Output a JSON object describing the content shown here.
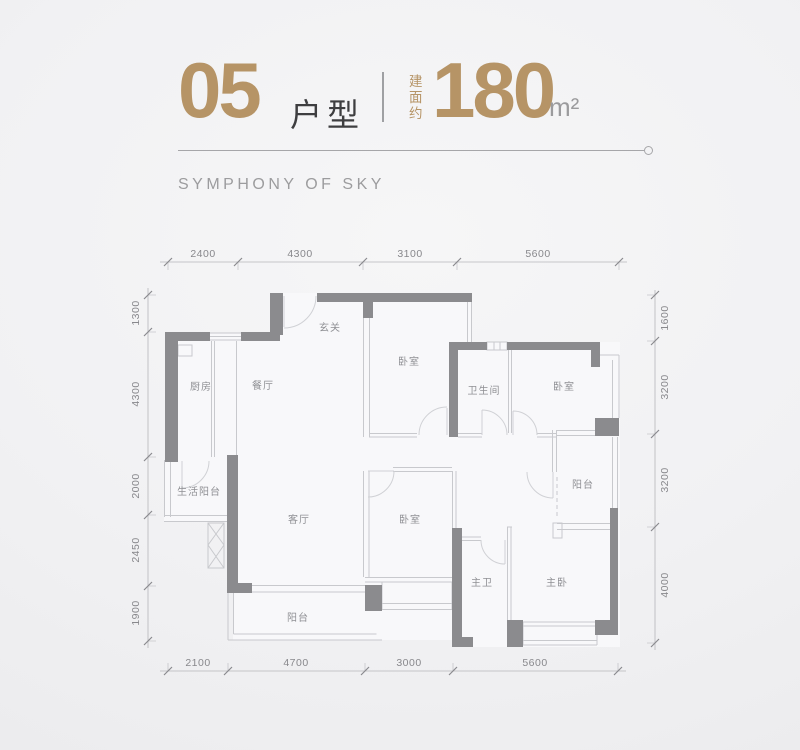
{
  "header": {
    "unit_number": "05",
    "unit_type_label": "户型",
    "area_prefix": "建面约",
    "area_value": "180",
    "area_unit": "m²",
    "subtitle": "SYMPHONY OF SKY"
  },
  "colors": {
    "accent_gold": "#b69466",
    "dark_text": "#3e3e40",
    "wall_dark": "#8b8b8e",
    "wall_light": "#c8c9cd",
    "dim_text": "#88888c",
    "room_text": "#8f9094"
  },
  "floorplan": {
    "rooms": {
      "entry": "玄关",
      "bedroom_top": "卧室",
      "kitchen": "厨房",
      "dining": "餐厅",
      "bathroom": "卫生间",
      "bedroom_right": "卧室",
      "utility_balcony": "生活阳台",
      "living": "客厅",
      "bedroom_mid": "卧室",
      "balcony_right": "阳台",
      "master_bath": "主卫",
      "master_bedroom": "主卧",
      "balcony_bottom": "阳台"
    },
    "dims_top": [
      "2400",
      "4300",
      "3100",
      "5600"
    ],
    "dims_bottom": [
      "2100",
      "4700",
      "3000",
      "5600"
    ],
    "dims_left": [
      "1300",
      "4300",
      "2000",
      "2450",
      "1900"
    ],
    "dims_right": [
      "1600",
      "3200",
      "3200",
      "4000"
    ]
  }
}
